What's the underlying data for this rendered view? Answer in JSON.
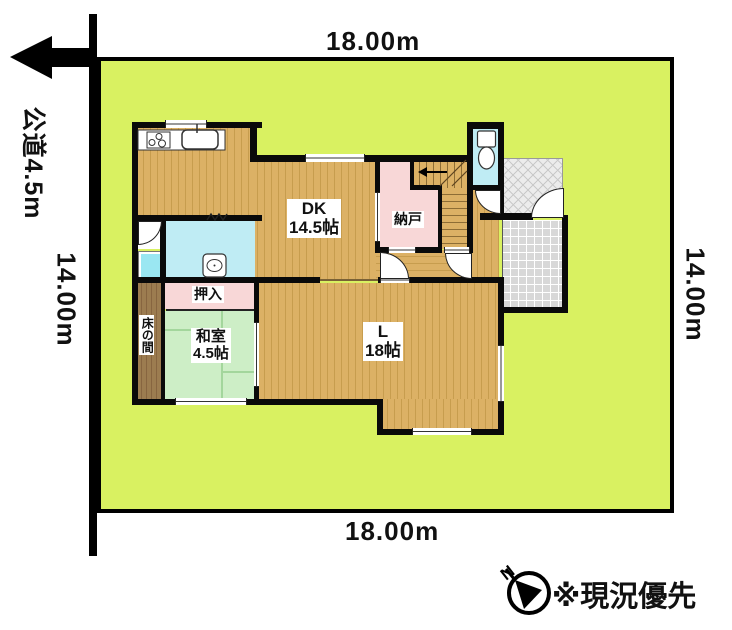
{
  "labels": {
    "top_width": "18.00m",
    "bottom_width": "18.00m",
    "left_depth": "14.00m",
    "right_depth": "14.00m",
    "road": "公道4.5m",
    "note": "※現況優先",
    "compass_n": "N"
  },
  "rooms": {
    "dk_name": "DK",
    "dk_size": "14.5帖",
    "living_name": "L",
    "living_size": "18帖",
    "washitsu_name": "和室",
    "washitsu_size": "4.5帖",
    "nando": "納戸",
    "oshiire": "押入",
    "tokonoma": "床の間"
  },
  "colors": {
    "lot_green": "#d9f161",
    "floor_tan": "#dcb165",
    "floor_stripe": "#c79d4e",
    "room_pink": "#f8d7d7",
    "water_cyan": "#bfecf4",
    "bath_cyan": "#9ae7f2",
    "tatami_green": "#cdeec6",
    "tatami_line": "#a3d69c",
    "tokonoma_brown": "#9c7c50",
    "tokonoma_stripe": "#876540",
    "genkan_gray": "#d8d8d8",
    "porch_gray": "#ececec"
  }
}
